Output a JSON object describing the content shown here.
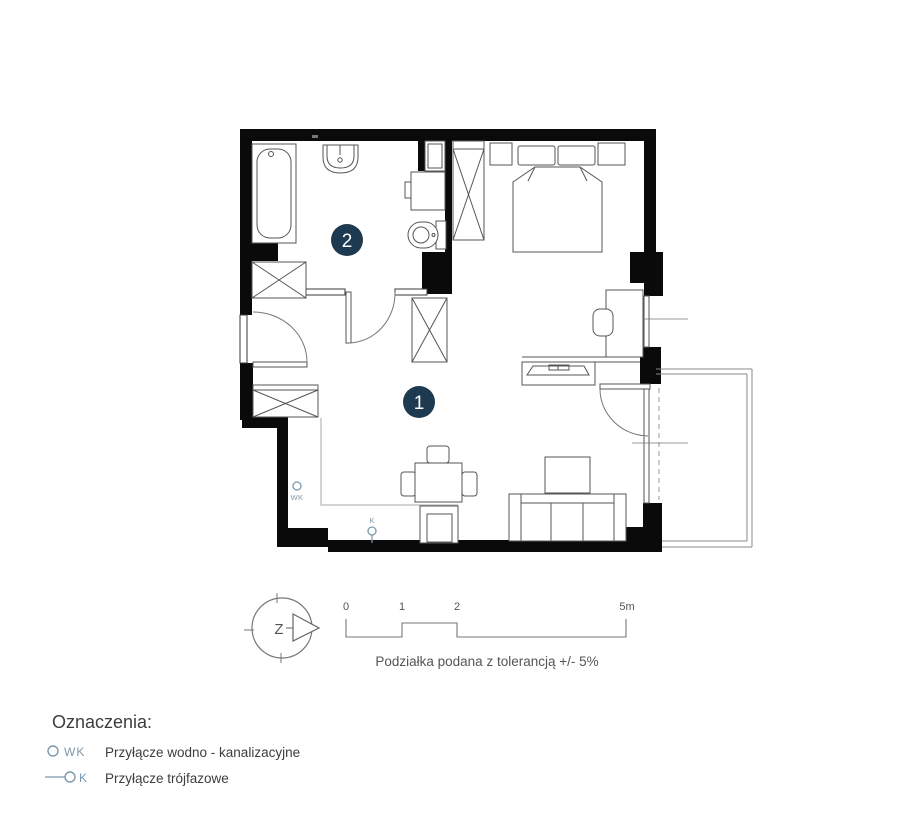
{
  "plan": {
    "rooms": [
      {
        "number": "1"
      },
      {
        "number": "2"
      }
    ],
    "markers": {
      "wk": "WK",
      "k": "K"
    }
  },
  "compass": {
    "letter": "Z"
  },
  "scale_bar": {
    "ticks": [
      "0",
      "1",
      "2",
      "5m"
    ],
    "caption": "Podziałka podana z tolerancją +/- 5%"
  },
  "legend": {
    "heading": "Oznaczenia:",
    "items": [
      {
        "symbol": "WK",
        "label": "Przyłącze wodno - kanalizacyjne"
      },
      {
        "symbol": "K",
        "label": "Przyłącze trójfazowe"
      }
    ]
  },
  "colors": {
    "wall": "#0a0a0a",
    "badge": "#1d3a50",
    "marker": "#7d98ac",
    "line": "#555555"
  }
}
